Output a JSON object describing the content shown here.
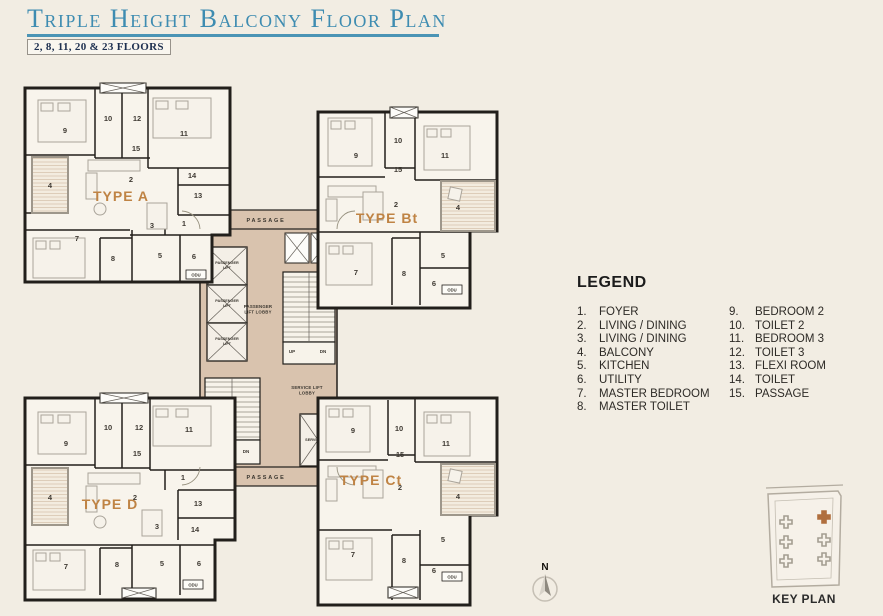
{
  "title": "Triple Height Balcony Floor Plan",
  "subtitle": "2, 8, 11, 20 & 23 FLOORS",
  "colors": {
    "title_blue": "#3e8cb1",
    "accent_orange": "#bf8344",
    "core_tan": "#d9c3ae",
    "wall_black": "#221f1b",
    "background": "#f2ede3",
    "keyplan_highlight": "#b06f3e"
  },
  "legend": {
    "heading": "LEGEND",
    "items": [
      {
        "num": "1.",
        "label": "FOYER"
      },
      {
        "num": "2.",
        "label": "LIVING / DINING"
      },
      {
        "num": "3.",
        "label": "LIVING / DINING"
      },
      {
        "num": "4.",
        "label": "BALCONY"
      },
      {
        "num": "5.",
        "label": "KITCHEN"
      },
      {
        "num": "6.",
        "label": "UTILITY"
      },
      {
        "num": "7.",
        "label": "MASTER BEDROOM"
      },
      {
        "num": "8.",
        "label": "MASTER TOILET"
      },
      {
        "num": "9.",
        "label": "BEDROOM 2"
      },
      {
        "num": "10.",
        "label": "TOILET 2"
      },
      {
        "num": "11.",
        "label": "BEDROOM 3"
      },
      {
        "num": "12.",
        "label": "TOILET 3"
      },
      {
        "num": "13.",
        "label": "FLEXI ROOM"
      },
      {
        "num": "14.",
        "label": "TOILET"
      },
      {
        "num": "15.",
        "label": "PASSAGE"
      }
    ]
  },
  "plan": {
    "wings": [
      {
        "label": "TYPE A",
        "label_x": 121,
        "label_y": 201,
        "rooms": [
          {
            "n": "9",
            "x": 65,
            "y": 133
          },
          {
            "n": "10",
            "x": 108,
            "y": 121
          },
          {
            "n": "12",
            "x": 137,
            "y": 121
          },
          {
            "n": "11",
            "x": 184,
            "y": 136
          },
          {
            "n": "15",
            "x": 136,
            "y": 151
          },
          {
            "n": "4",
            "x": 50,
            "y": 188
          },
          {
            "n": "2",
            "x": 131,
            "y": 182
          },
          {
            "n": "14",
            "x": 192,
            "y": 178
          },
          {
            "n": "13",
            "x": 198,
            "y": 198
          },
          {
            "n": "1",
            "x": 184,
            "y": 226
          },
          {
            "n": "3",
            "x": 152,
            "y": 228
          },
          {
            "n": "7",
            "x": 77,
            "y": 241
          },
          {
            "n": "8",
            "x": 113,
            "y": 261
          },
          {
            "n": "5",
            "x": 160,
            "y": 258
          },
          {
            "n": "6",
            "x": 194,
            "y": 259
          }
        ]
      },
      {
        "label": "TYPE Bt",
        "label_x": 387,
        "label_y": 223,
        "rooms": [
          {
            "n": "9",
            "x": 356,
            "y": 158
          },
          {
            "n": "10",
            "x": 398,
            "y": 143
          },
          {
            "n": "11",
            "x": 445,
            "y": 158
          },
          {
            "n": "15",
            "x": 398,
            "y": 172
          },
          {
            "n": "2",
            "x": 396,
            "y": 207
          },
          {
            "n": "4",
            "x": 458,
            "y": 210
          },
          {
            "n": "7",
            "x": 356,
            "y": 275
          },
          {
            "n": "8",
            "x": 404,
            "y": 276
          },
          {
            "n": "5",
            "x": 443,
            "y": 258
          },
          {
            "n": "6",
            "x": 434,
            "y": 286
          }
        ]
      },
      {
        "label": "TYPE D",
        "label_x": 110,
        "label_y": 509,
        "rooms": [
          {
            "n": "9",
            "x": 66,
            "y": 446
          },
          {
            "n": "10",
            "x": 108,
            "y": 430
          },
          {
            "n": "12",
            "x": 139,
            "y": 430
          },
          {
            "n": "11",
            "x": 189,
            "y": 432
          },
          {
            "n": "15",
            "x": 137,
            "y": 456
          },
          {
            "n": "4",
            "x": 50,
            "y": 500
          },
          {
            "n": "2",
            "x": 135,
            "y": 500
          },
          {
            "n": "1",
            "x": 183,
            "y": 480
          },
          {
            "n": "13",
            "x": 198,
            "y": 506
          },
          {
            "n": "14",
            "x": 195,
            "y": 532
          },
          {
            "n": "3",
            "x": 157,
            "y": 529
          },
          {
            "n": "7",
            "x": 66,
            "y": 569
          },
          {
            "n": "8",
            "x": 117,
            "y": 567
          },
          {
            "n": "5",
            "x": 162,
            "y": 566
          },
          {
            "n": "6",
            "x": 199,
            "y": 566
          }
        ]
      },
      {
        "label": "TYPE Ct",
        "label_x": 371,
        "label_y": 485,
        "rooms": [
          {
            "n": "9",
            "x": 353,
            "y": 433
          },
          {
            "n": "10",
            "x": 399,
            "y": 431
          },
          {
            "n": "11",
            "x": 446,
            "y": 446
          },
          {
            "n": "15",
            "x": 400,
            "y": 457
          },
          {
            "n": "2",
            "x": 400,
            "y": 490
          },
          {
            "n": "4",
            "x": 458,
            "y": 499
          },
          {
            "n": "7",
            "x": 353,
            "y": 557
          },
          {
            "n": "8",
            "x": 404,
            "y": 563
          },
          {
            "n": "5",
            "x": 443,
            "y": 542
          },
          {
            "n": "6",
            "x": 434,
            "y": 573
          }
        ]
      }
    ],
    "core": {
      "passage": "PASSAGE",
      "passenger_lift": "PASSENGER\nLIFT",
      "passenger_lift_lobby": "PASSENGER\nLIFT LOBBY",
      "service_lift_lobby": "SERVICE LIFT\nLOBBY",
      "service_lift": "SERVICE LIFT",
      "up": "UP",
      "dn": "DN"
    },
    "odu": "ODU"
  },
  "north_label": "N",
  "keyplan": {
    "label": "KEY PLAN"
  }
}
